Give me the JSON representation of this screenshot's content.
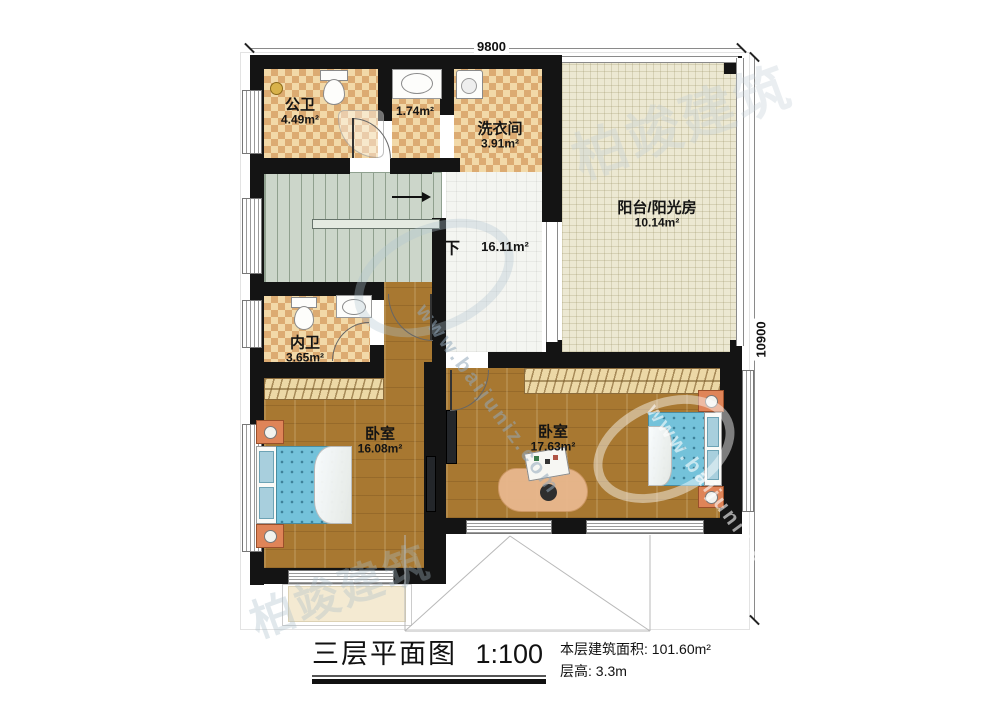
{
  "dimensions": {
    "top": "9800",
    "right": "10900"
  },
  "rooms": {
    "gongwei": {
      "name": "公卫",
      "area": "4.49m²"
    },
    "alcove": {
      "area": "1.74m²"
    },
    "laundry": {
      "name": "洗衣间",
      "area": "3.91m²"
    },
    "balcony": {
      "name": "阳台/阳光房",
      "area": "10.14m²"
    },
    "hall": {
      "area": "16.11m²",
      "stair_direction": "下"
    },
    "neiwei": {
      "name": "内卫",
      "area": "3.65m²"
    },
    "bedroom_left": {
      "name": "卧室",
      "area": "16.08m²"
    },
    "bedroom_right": {
      "name": "卧室",
      "area": "17.63m²"
    }
  },
  "legend": {
    "title": "三层平面图",
    "scale": "1:100",
    "floor_area_label": "本层建筑面积:",
    "floor_area_value": "101.60m²",
    "floor_height_label": "层高:",
    "floor_height_value": "3.3m"
  },
  "watermark": {
    "brand": "柏竣建筑",
    "url": "www.baijuniz.com"
  },
  "colors": {
    "wall": "#141414",
    "checker_light": "#f2d9a8",
    "checker_dark": "#dcab72",
    "wood_floor": "#a87831",
    "hall_tile": "#f4f5f1",
    "stair": "#ccd6ca",
    "balcony_floor": "#ece8d2",
    "bed_blue": "#74c2da",
    "nightstand_orange": "#df8458",
    "watermark_blue": "#8fa8ba"
  }
}
